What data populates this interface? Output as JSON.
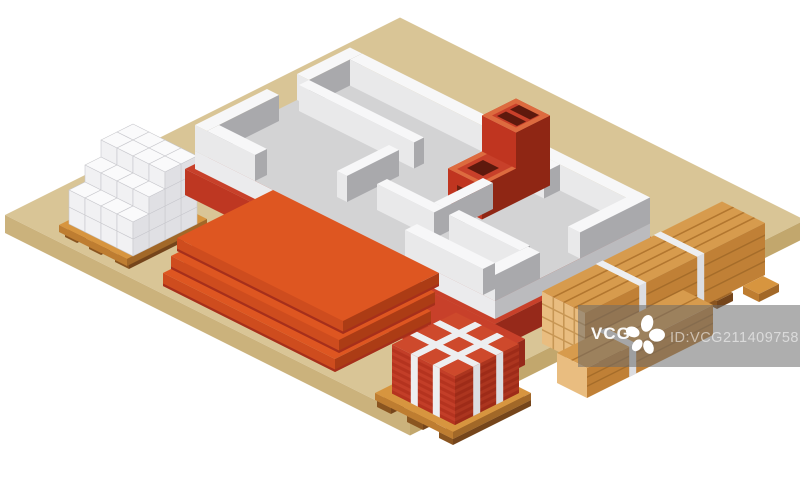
{
  "watermark": {
    "brand": "VCG",
    "id": "ID:VCG211409758111",
    "logo_icon": "vcg-pinwheel-icon",
    "bar_color": "rgba(108,108,108,0.55)",
    "brand_color": "rgba(255,255,255,0.95)",
    "id_color": "rgba(255,255,255,0.55)"
  },
  "palette": {
    "bg": "#FFFFFF",
    "ground_top": "#D9C596",
    "ground_left": "#CBB27C",
    "ground_right": "#C2A76D",
    "concrete_top": "#D3D3D4",
    "concrete_left": "#EBEBED",
    "concrete_right": "#BBBBBE",
    "wall_top": "#F7F7F8",
    "wall_left": "#E9E9EA",
    "wall_right": "#A9A9AC",
    "red_top": "#C8402A",
    "red_left": "#BE3722",
    "red_right": "#96291A",
    "chimney_top": "#C8402A",
    "chimney_left": "#C03520",
    "chimney_right": "#8F2614",
    "chimney_rim": "#DD6B3F",
    "chimney_hole": "#5E190D",
    "chimney_opening": "#70200F",
    "orange_top": "#DE5621",
    "orange_left": "#CE4C1E",
    "orange_right": "#AC3C15",
    "orange_shadow": "#A62F1B",
    "box_top": "#FAFAFB",
    "box_left": "#F1F1F3",
    "box_right": "#E0E0E4",
    "box_stroke": "#C8C8CD",
    "pallet_top": "#D7953F",
    "pallet_left": "#BE7D31",
    "pallet_right": "#A26828",
    "skid_top": "#A06627",
    "skid_left": "#8A5520",
    "skid_right": "#75451B",
    "brick_top": "#CE492C",
    "brick_left_a": "#C33E28",
    "brick_left_b": "#B5331F",
    "brick_right_a": "#AC351F",
    "brick_right_b": "#9E2B18",
    "strap": "#EDEEF0",
    "strap_shade": "#DCDDE1",
    "wood_top": "#D79B4D",
    "wood_end": "#E9BD80",
    "wood_side": "#C08036",
    "wood_line": "#B2762F",
    "wood_line_dark": "#A56C2A",
    "wood_end_line": "#C79654"
  }
}
